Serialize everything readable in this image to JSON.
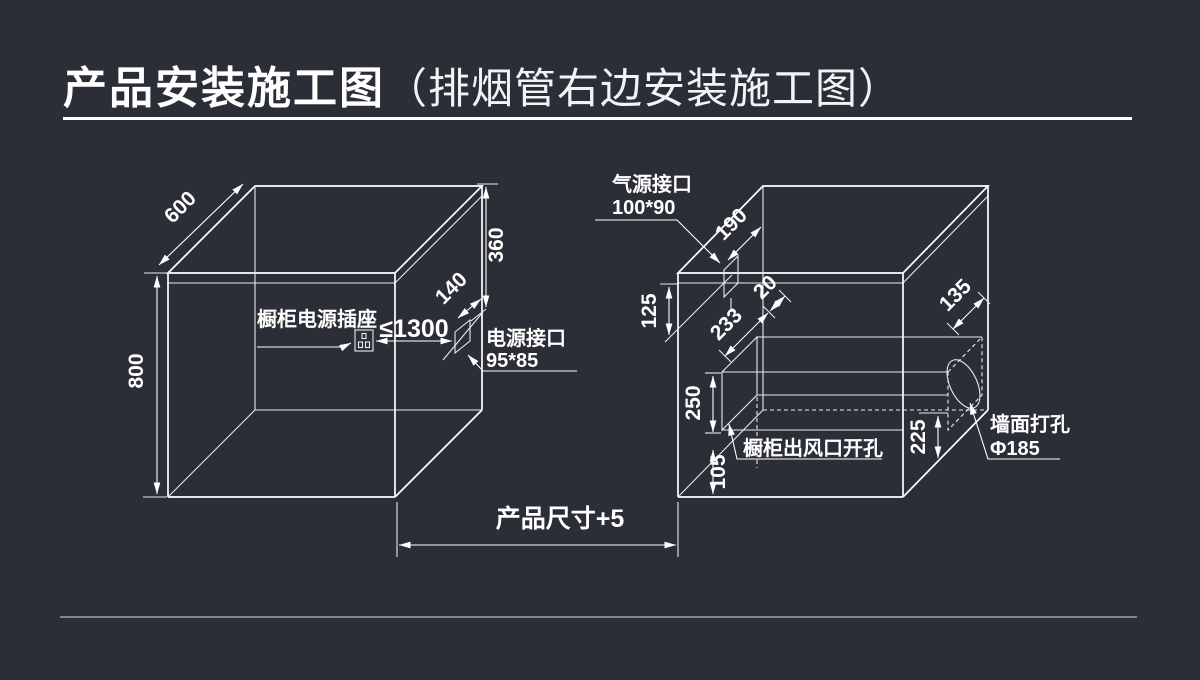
{
  "page": {
    "background": "#2b2d37",
    "line_color": "#ffffff"
  },
  "header": {
    "title": "产品安装施工图",
    "subtitle": "（排烟管右边安装施工图）"
  },
  "left_cabinet": {
    "dim_depth": "600",
    "dim_height": "800",
    "dim_top_height": "360",
    "dim_port_offset": "140",
    "socket_label": "橱柜电源插座",
    "dim_socket_distance": "≤1300",
    "power_port_line1": "电源接口",
    "power_port_line2": "95*85"
  },
  "right_cabinet": {
    "gas_port_line1": "气源接口",
    "gas_port_line2": "100*90",
    "dim_gas_offset": "190",
    "dim_top_clearance": "125",
    "dim_duct_depth": "233",
    "dim_duct_gap": "20",
    "dim_opening_height": "250",
    "dim_opening_bottom": "105",
    "opening_label": "橱柜出风口开孔",
    "dim_wall_offset": "135",
    "dim_right_height": "225",
    "wall_hole_line1": "墙面打孔",
    "wall_hole_line2": "Φ185"
  },
  "footer": {
    "dim_product_size": "产品尺寸+5"
  }
}
